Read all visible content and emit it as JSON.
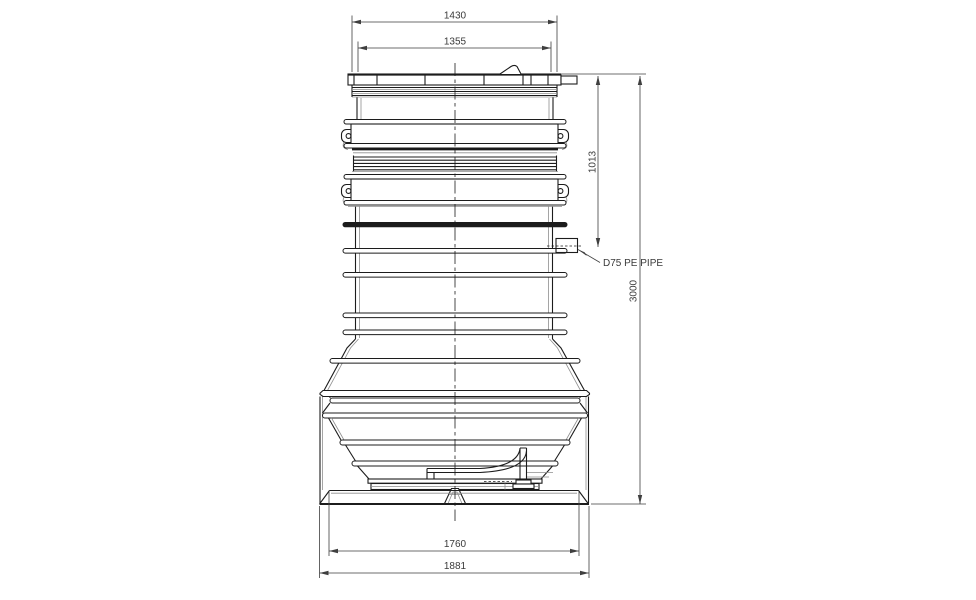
{
  "drawing": {
    "title": "pump-station-elevation-drawing",
    "dimensions": {
      "top_outer_width": "1430",
      "top_inner_width": "1355",
      "inlet_depth": "1013",
      "overall_height": "3000",
      "base_top_width": "1760",
      "base_overall_width": "1881"
    },
    "labels": {
      "inlet_pipe": "D75 PE PIPE"
    },
    "colors": {
      "line": "#1c1c1c",
      "line_light": "#8f8f8f",
      "dim": "#3f3f3f",
      "text": "#3a3a3a",
      "background": "#ffffff"
    }
  }
}
